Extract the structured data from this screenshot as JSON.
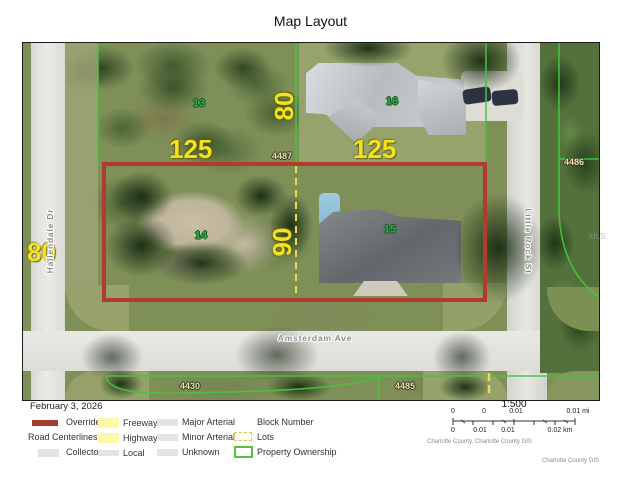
{
  "title": "Map Layout",
  "map": {
    "lots": {
      "nw": "13",
      "ne": "16",
      "sw": "14",
      "se": "15"
    },
    "blocks": {
      "top": "4487",
      "right": "4486",
      "bottom_left": "4430",
      "bottom_right": "4485"
    },
    "dims": {
      "left_width": "125",
      "right_width": "125",
      "top_depth": "80",
      "mid_depth": "90",
      "left_road": "80"
    },
    "streets": {
      "bottom": "Amsterdam Ave",
      "right": "Little Rock St",
      "left": "Hallendale Dr"
    },
    "watermark": "MLS",
    "colors": {
      "parcel_red": "#b23b2d",
      "ownership_green": "#46c43c",
      "lot_dash_yellow": "#e9db4e",
      "dim_yellow": "#f2e222",
      "lot_number_green": "#28b545",
      "block_number_yellow": "#f0e8a2"
    }
  },
  "legend": {
    "date": "February 3, 2026",
    "override": "Override 1",
    "road_centerlines": "Road Centerlines",
    "collector": "Collector",
    "freeway": "Freeway",
    "highway": "Highway",
    "local": "Local",
    "major_arterial": "Major Arterial",
    "minor_arterial": "Minor Arterial",
    "unknown": "Unknown",
    "block_number": "Block Number",
    "lots": "Lots",
    "property_ownership": "Property Ownership"
  },
  "scale": {
    "ratio": "1:500",
    "mi_ticks": [
      "0",
      "0",
      "0.01",
      "0.01 mi"
    ],
    "km_ticks": [
      "0",
      "0.01",
      "0.01",
      "0.02 km"
    ],
    "credit": "Charlotte County, Charlotte County GIS",
    "credit_right": "Charlotte County GIS"
  }
}
